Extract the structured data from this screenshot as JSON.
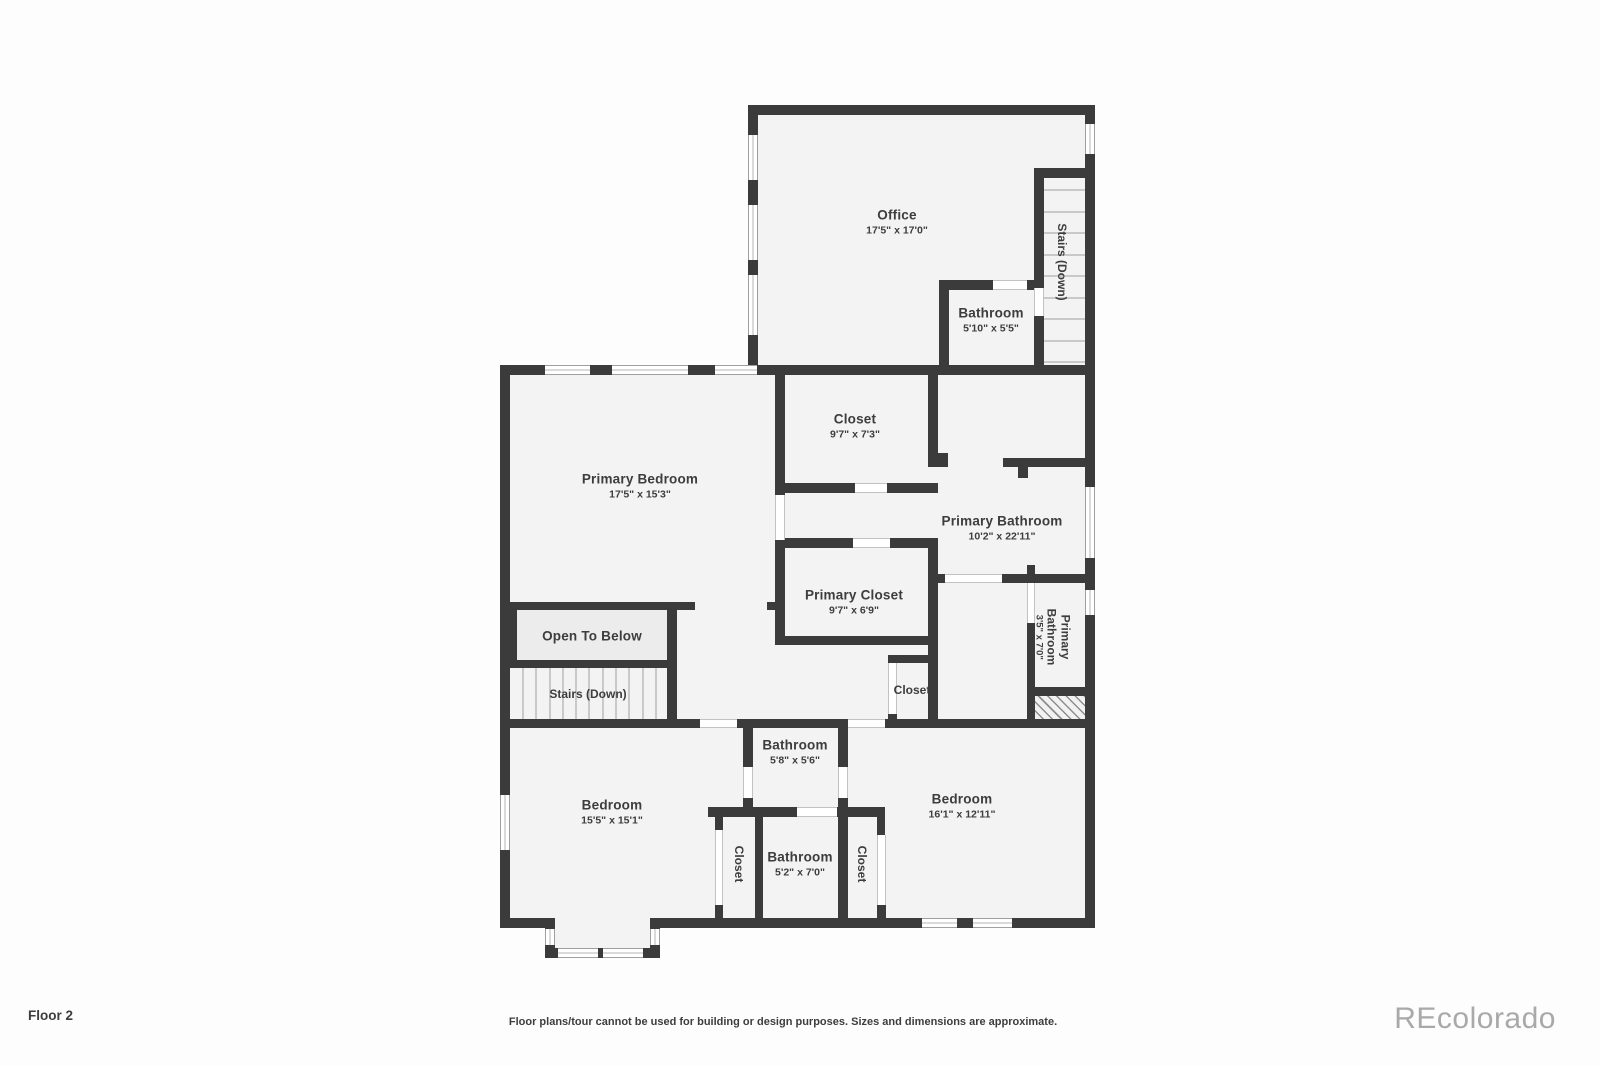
{
  "floor_label": "Floor 2",
  "disclaimer": "Floor plans/tour cannot be used for building or design purposes. Sizes and dimensions are approximate.",
  "watermark": "REcolorado",
  "colors": {
    "wall": "#3b3b3b",
    "floor": "#f4f3f3",
    "open_to_below_fill": "#ececec",
    "window_frame": "#9f9f9f",
    "label_text": "#3d3d3d",
    "watermark_text": "#a9a9a9"
  },
  "rooms": {
    "office": {
      "name": "Office",
      "dims": "17'5\" x 17'0\""
    },
    "office_bathroom": {
      "name": "Bathroom",
      "dims": "5'10\" x 5'5\""
    },
    "stairs_upper": {
      "name": "Stairs (Down)"
    },
    "closet_upper": {
      "name": "Closet",
      "dims": "9'7\" x 7'3\""
    },
    "primary_bedroom": {
      "name": "Primary Bedroom",
      "dims": "17'5\" x 15'3\""
    },
    "primary_bathroom": {
      "name": "Primary Bathroom",
      "dims": "10'2\" x 22'11\""
    },
    "primary_closet": {
      "name": "Primary Closet",
      "dims": "9'7\" x 6'9\""
    },
    "primary_bathroom_small": {
      "name_line1": "Primary",
      "name_line2": "Bathroom",
      "dims": "3'5\" x 7'0\""
    },
    "open_to_below": {
      "name": "Open To Below"
    },
    "stairs_middle": {
      "name": "Stairs (Down)"
    },
    "hall_closet": {
      "name": "Closet"
    },
    "bathroom_jack": {
      "name": "Bathroom",
      "dims": "5'8\" x 5'6\""
    },
    "bathroom_lower": {
      "name": "Bathroom",
      "dims": "5'2\" x 7'0\""
    },
    "closet_left": {
      "name": "Closet"
    },
    "closet_right": {
      "name": "Closet"
    },
    "bedroom_left": {
      "name": "Bedroom",
      "dims": "15'5\" x 15'1\""
    },
    "bedroom_right": {
      "name": "Bedroom",
      "dims": "16'1\" x 12'11\""
    }
  }
}
